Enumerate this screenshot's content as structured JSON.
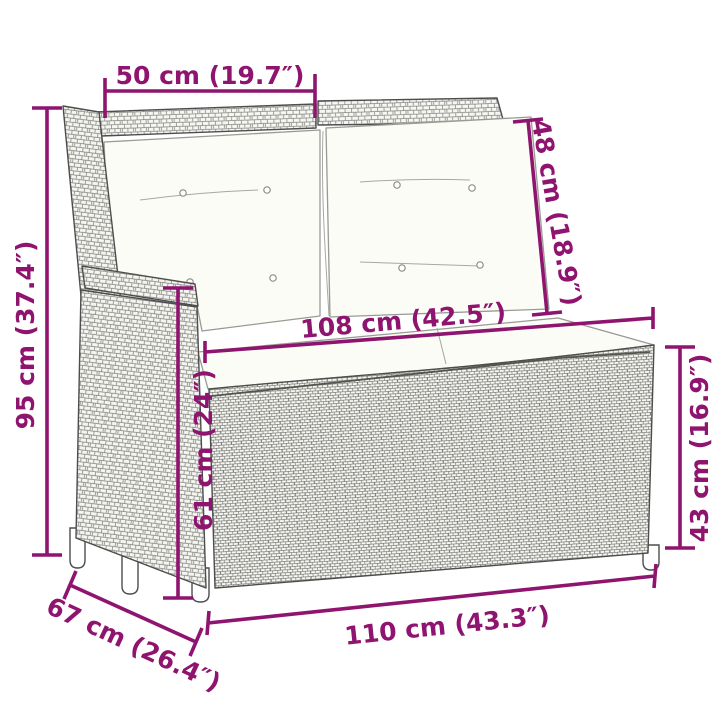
{
  "diagram": {
    "kind": "product-dimension-drawing",
    "product": "rattan-reclining-garden-bench-with-cushions",
    "accent_color": "#8F1470",
    "line_art_color": "#4d4d4d",
    "cushion_color": "#fcfcf6",
    "dimensions": [
      {
        "id": "top-width",
        "cm": 50,
        "inches": 19.7,
        "label": "50 cm (19.7″)"
      },
      {
        "id": "backrest-cushion-height",
        "cm": 48,
        "inches": 18.9,
        "label": "48 cm (18.9″)"
      },
      {
        "id": "total-height",
        "cm": 95,
        "inches": 37.4,
        "label": "95 cm (37.4″)"
      },
      {
        "id": "seat-width",
        "cm": 108,
        "inches": 42.5,
        "label": "108 cm (42.5″)"
      },
      {
        "id": "armrest-height",
        "cm": 61,
        "inches": 24,
        "label": "61 cm (24″)"
      },
      {
        "id": "seat-height",
        "cm": 43,
        "inches": 16.9,
        "label": "43 cm (16.9″)"
      },
      {
        "id": "depth",
        "cm": 67,
        "inches": 26.4,
        "label": "67 cm (26.4″)"
      },
      {
        "id": "total-width",
        "cm": 110,
        "inches": 43.3,
        "label": "110 cm (43.3″)"
      }
    ]
  }
}
